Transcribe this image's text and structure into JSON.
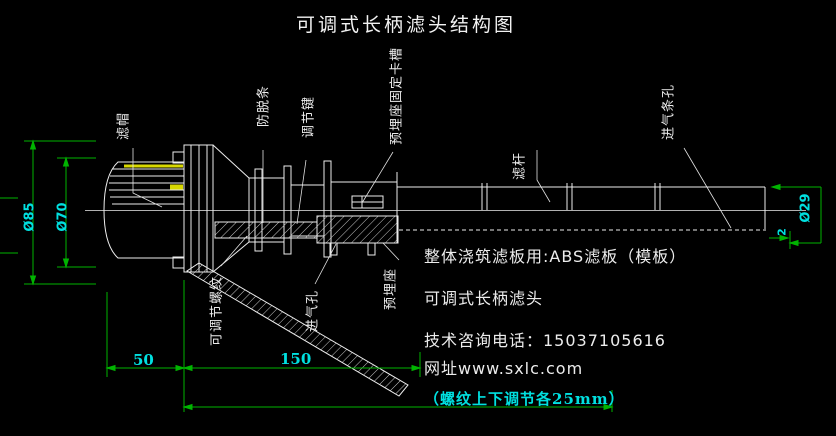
{
  "title": "可调式长柄滤头结构图",
  "part_labels": {
    "filter_cap": "滤帽",
    "anti_off_strip": "防脱条",
    "adjust_key": "调节键",
    "embed_seat_slot": "预埋座固定卡槽",
    "filter_rod": "滤杆",
    "air_inlet_slots": "进气条孔",
    "adjustable_thread": "可调节螺纹",
    "air_inlet_hole": "进气孔",
    "embed_seat": "预埋座"
  },
  "dimensions": {
    "cap_outer_dia": "Ø85",
    "cap_inner_dia": "Ø70",
    "rod_dia": "Ø29",
    "wall_thickness": "2",
    "seg_50": "50",
    "seg_150": "150",
    "thread_note": "（螺纹上下调节各25mm）"
  },
  "notes": {
    "abs_board": "整体浇筑滤板用:ABS滤板（模板）",
    "product_name": "可调式长柄滤头",
    "phone": "技术咨询电话：15037105616",
    "website": "网址www.sxlc.com"
  },
  "colors": {
    "background": "#000000",
    "line_white": "#ededed",
    "dim_green": "#00b400",
    "dim_cyan": "#00e0e0",
    "slot_yellow": "#d8d800"
  }
}
